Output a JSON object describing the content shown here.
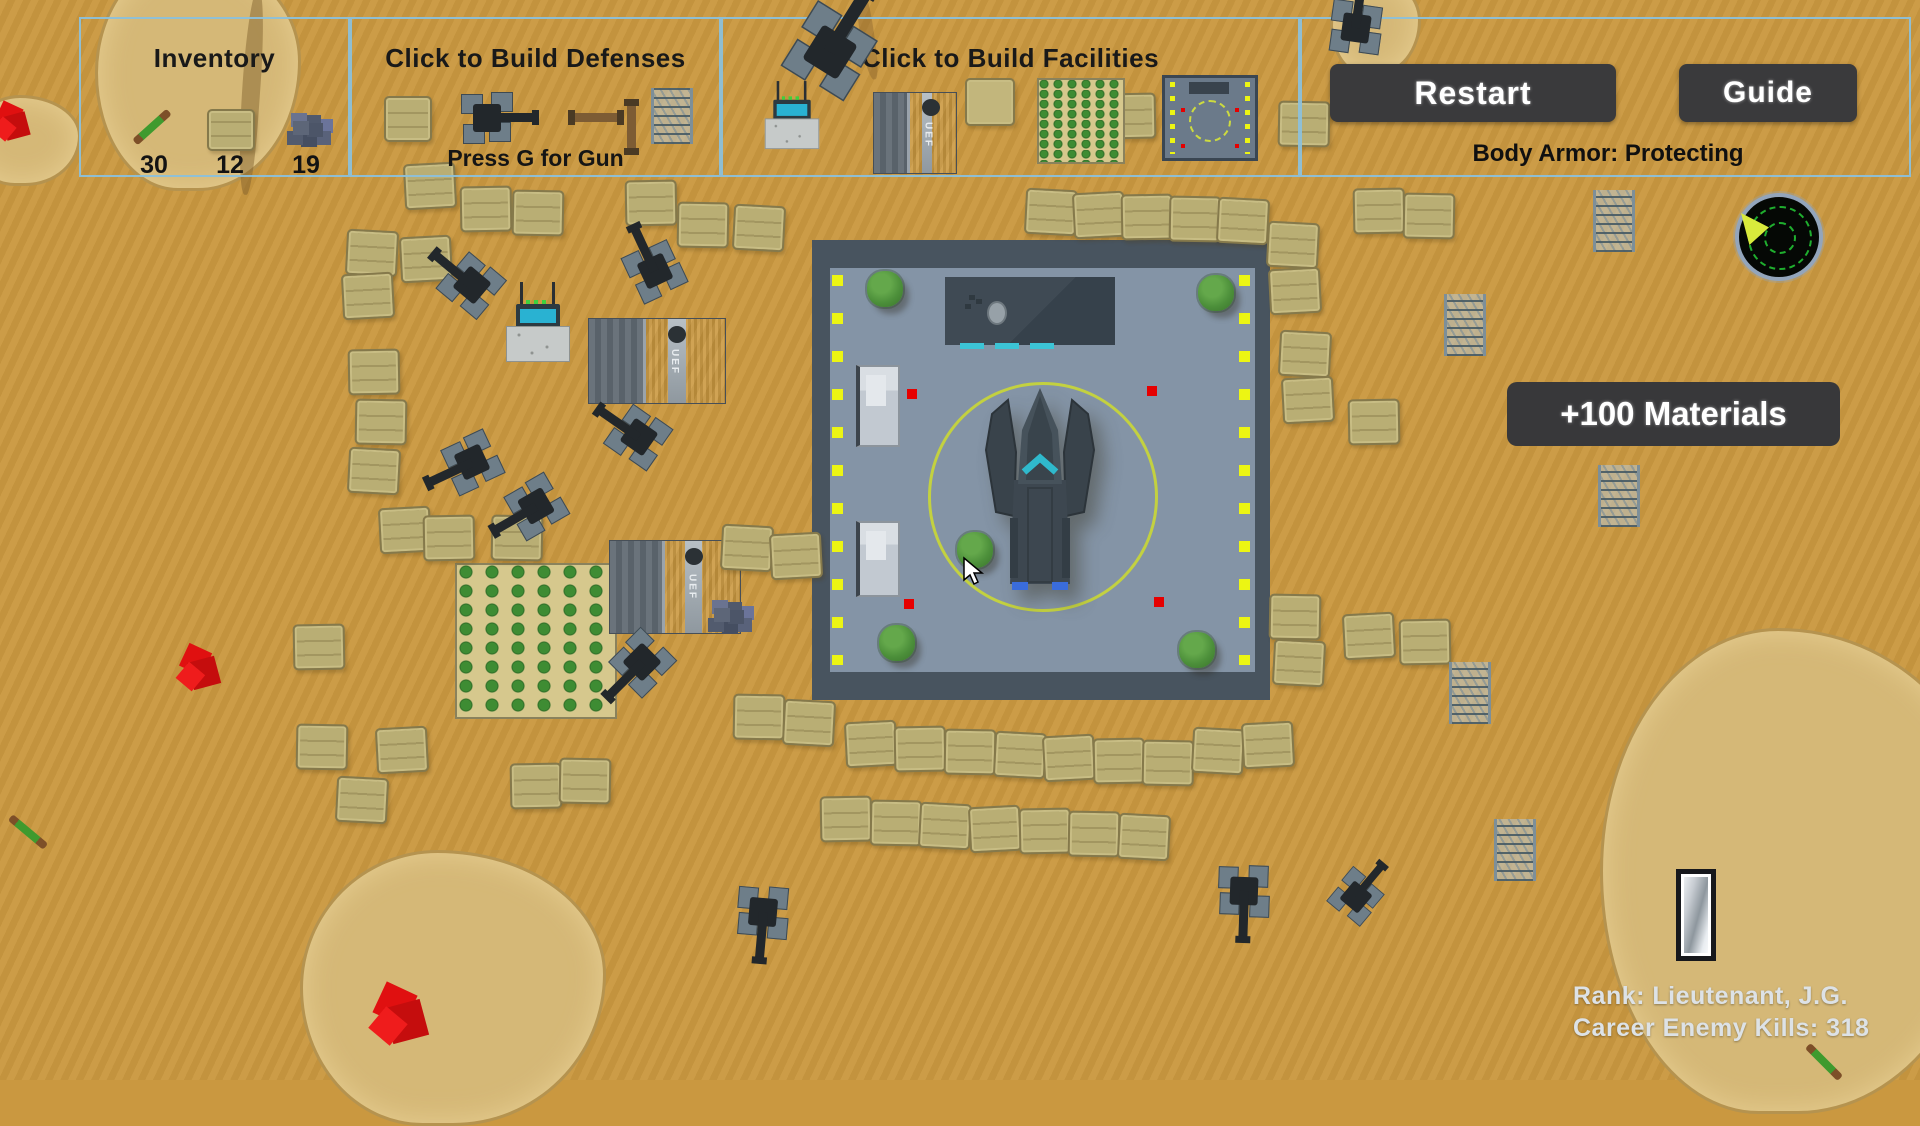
{
  "hud": {
    "inventory": {
      "title": "Inventory",
      "items": [
        {
          "icon": "javelin-icon",
          "count": "30"
        },
        {
          "icon": "sandbag-icon",
          "count": "12"
        },
        {
          "icon": "materials-icon",
          "count": "19"
        }
      ]
    },
    "defenses": {
      "title": "Click to Build Defenses",
      "hint": "Press G for Gun",
      "icons": [
        "sandbag-icon",
        "gun-turret-icon",
        "pipe-icon",
        "pole-icon",
        "barbed-wire-icon"
      ]
    },
    "facilities": {
      "title": "Click to Build Facilities",
      "icons": [
        "radio-station-icon",
        "bunker-icon",
        "pad-icon",
        "farm-icon",
        "landing-pad-icon"
      ]
    },
    "system": {
      "restart_label": "Restart",
      "guide_label": "Guide",
      "status": "Body Armor: Protecting"
    }
  },
  "toast": {
    "label": "+100 Materials"
  },
  "career": {
    "rank": "Rank: Lieutenant, J.G.",
    "kills": "Career Enemy Kills: 318"
  },
  "map_labels": {
    "bunker_text": "UEF"
  },
  "colors": {
    "sand": "#ca9840",
    "panel_border": "#8cc0da",
    "button_bg": "#3a3a3c",
    "pad_inner": "#8494a6",
    "pad_frame": "#48545f",
    "landing_circle": "#c3d140",
    "dot_yellow": "#ecf513",
    "alert_red": "#e60000",
    "radar_green": "#1fae2e"
  },
  "map": {
    "sandbags": [
      [
        428,
        184
      ],
      [
        484,
        207
      ],
      [
        536,
        211
      ],
      [
        370,
        251
      ],
      [
        424,
        257
      ],
      [
        649,
        201
      ],
      [
        701,
        223
      ],
      [
        757,
        226
      ],
      [
        366,
        294
      ],
      [
        372,
        370
      ],
      [
        379,
        420
      ],
      [
        372,
        469
      ],
      [
        403,
        528
      ],
      [
        447,
        536
      ],
      [
        515,
        536
      ],
      [
        745,
        546
      ],
      [
        794,
        554
      ],
      [
        317,
        645
      ],
      [
        320,
        745
      ],
      [
        360,
        798
      ],
      [
        400,
        748
      ],
      [
        534,
        784
      ],
      [
        583,
        779
      ],
      [
        1049,
        210
      ],
      [
        1097,
        213
      ],
      [
        1145,
        215
      ],
      [
        1193,
        217
      ],
      [
        1241,
        219
      ],
      [
        1062,
        112
      ],
      [
        1128,
        114
      ],
      [
        1302,
        122
      ],
      [
        1291,
        243
      ],
      [
        1293,
        289
      ],
      [
        1377,
        209
      ],
      [
        1427,
        214
      ],
      [
        1303,
        352
      ],
      [
        1306,
        398
      ],
      [
        1372,
        420
      ],
      [
        1293,
        615
      ],
      [
        1297,
        661
      ],
      [
        1367,
        634
      ],
      [
        1423,
        640
      ],
      [
        757,
        715
      ],
      [
        807,
        721
      ],
      [
        869,
        742
      ],
      [
        918,
        747
      ],
      [
        968,
        750
      ],
      [
        1018,
        753
      ],
      [
        1067,
        756
      ],
      [
        1117,
        759
      ],
      [
        1166,
        761
      ],
      [
        1216,
        749
      ],
      [
        1266,
        743
      ],
      [
        844,
        817
      ],
      [
        894,
        821
      ],
      [
        943,
        824
      ],
      [
        993,
        827
      ],
      [
        1043,
        829
      ],
      [
        1092,
        832
      ],
      [
        1142,
        835
      ]
    ],
    "turrets": [
      [
        472,
        285,
        -140,
        1,
        19
      ],
      [
        655,
        271,
        -115,
        1,
        19
      ],
      [
        639,
        437,
        -145,
        1,
        19
      ],
      [
        472,
        462,
        155,
        1,
        19
      ],
      [
        536,
        506,
        150,
        1,
        19
      ],
      [
        642,
        662,
        135,
        1,
        19
      ],
      [
        763,
        912,
        95,
        1,
        19
      ],
      [
        1244,
        891,
        92,
        1,
        19
      ],
      [
        1356,
        897,
        -50,
        0.85,
        19
      ],
      [
        830,
        52,
        -58,
        1.45,
        45
      ],
      [
        1356,
        28,
        -82,
        1,
        45
      ]
    ],
    "wires": [
      [
        1611,
        221
      ],
      [
        1462,
        325
      ],
      [
        1616,
        496
      ],
      [
        1467,
        693
      ],
      [
        1512,
        850
      ]
    ],
    "trees": [
      [
        885,
        289
      ],
      [
        1216,
        293
      ],
      [
        975,
        550
      ],
      [
        897,
        643
      ],
      [
        1197,
        650
      ]
    ],
    "pad_dots": [
      [
        912,
        394
      ],
      [
        1152,
        391
      ],
      [
        909,
        604
      ],
      [
        1159,
        602
      ]
    ],
    "enemies": [
      [
        12,
        122,
        40
      ],
      [
        199,
        668,
        46
      ],
      [
        400,
        1015,
        62
      ]
    ],
    "javelins": [
      [
        28,
        832,
        40
      ],
      [
        1824,
        1062,
        45
      ]
    ],
    "rockpiles": [
      [
        714,
        608
      ]
    ],
    "bunkers": [
      [
        588,
        318,
        136,
        84
      ],
      [
        609,
        540,
        130,
        92
      ]
    ],
    "radios": [
      [
        506,
        296,
        1
      ]
    ]
  }
}
